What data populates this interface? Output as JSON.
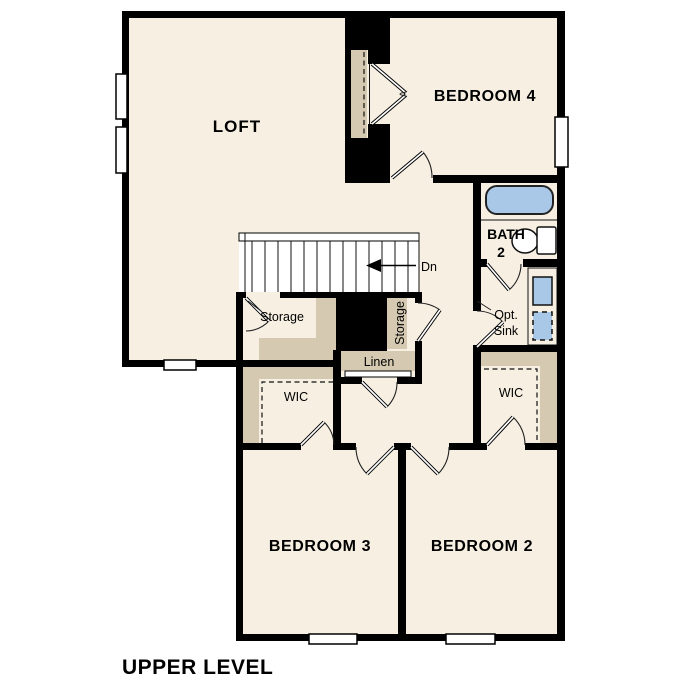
{
  "plan": {
    "caption": "UPPER LEVEL",
    "rooms": {
      "loft": "LOFT",
      "bedroom4": "BEDROOM 4",
      "bedroom3": "BEDROOM 3",
      "bedroom2": "BEDROOM 2",
      "bath": {
        "line1": "BATH",
        "line2": "2"
      },
      "wic_left": "WIC",
      "wic_right": "WIC",
      "linen": "Linen",
      "storage_room": "Storage",
      "storage_closet": "Storage"
    },
    "annotations": {
      "stair_direction": "Dn",
      "optional_sink": {
        "line1": "Opt.",
        "line2": "Sink"
      }
    },
    "colors": {
      "floor": "#f6efe2",
      "millwork_tan": "#d5c9b1",
      "fixture_blue": "#a9c7e7",
      "wall_black": "#000000",
      "background": "#ffffff"
    }
  }
}
